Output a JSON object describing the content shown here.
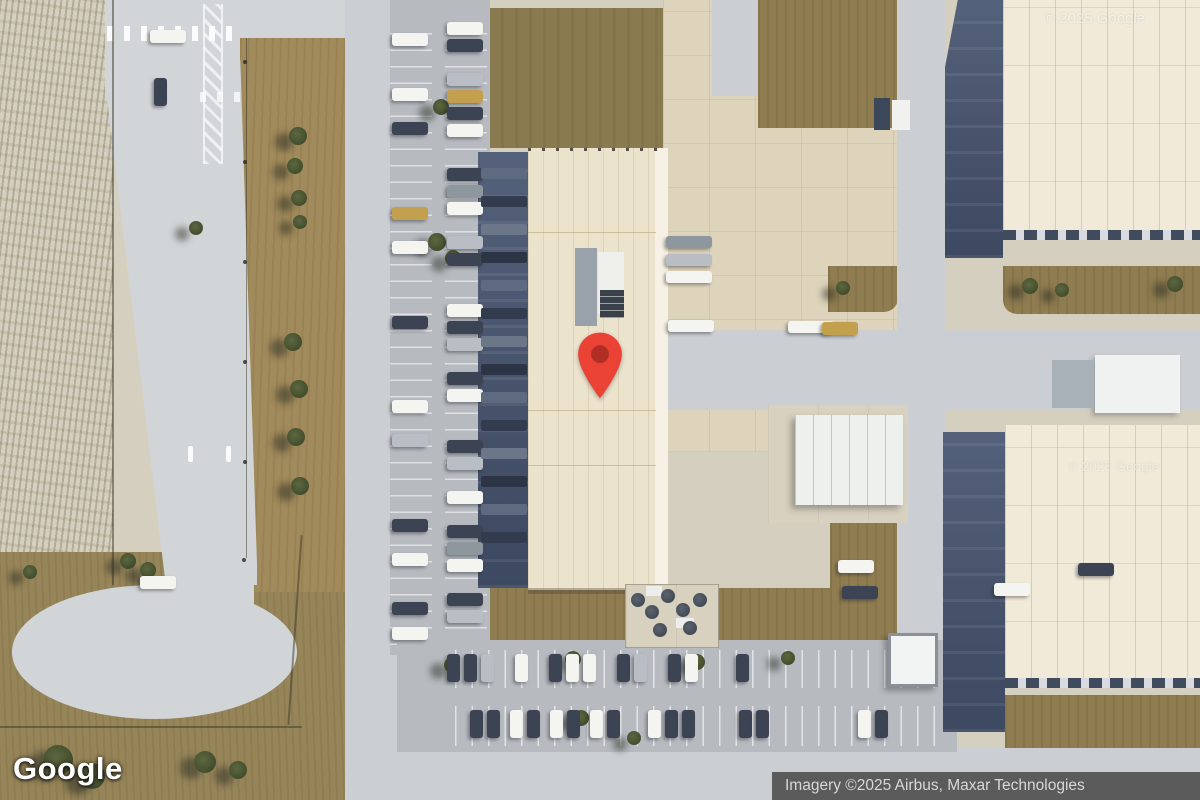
{
  "map": {
    "view_type": "satellite",
    "marker": {
      "color": "#EA4335",
      "inner_color": "#B02E23"
    }
  },
  "branding": {
    "logo": "Google"
  },
  "watermarks": {
    "top_right": "© 2025 Google",
    "center_right": "© 2025 Google"
  },
  "attribution": {
    "text": "Imagery ©2025 Airbus, Maxar Technologies"
  },
  "palette": {
    "car_dark": "#3c4454",
    "car_white": "#f4f4f1",
    "car_silver": "#b8bec4",
    "car_gray": "#8e969e",
    "car_tan": "#c2a04e",
    "trailer_gray": "#9aa1a9",
    "navy_dock": "#47536b",
    "building_cream": "#ece3cd"
  }
}
